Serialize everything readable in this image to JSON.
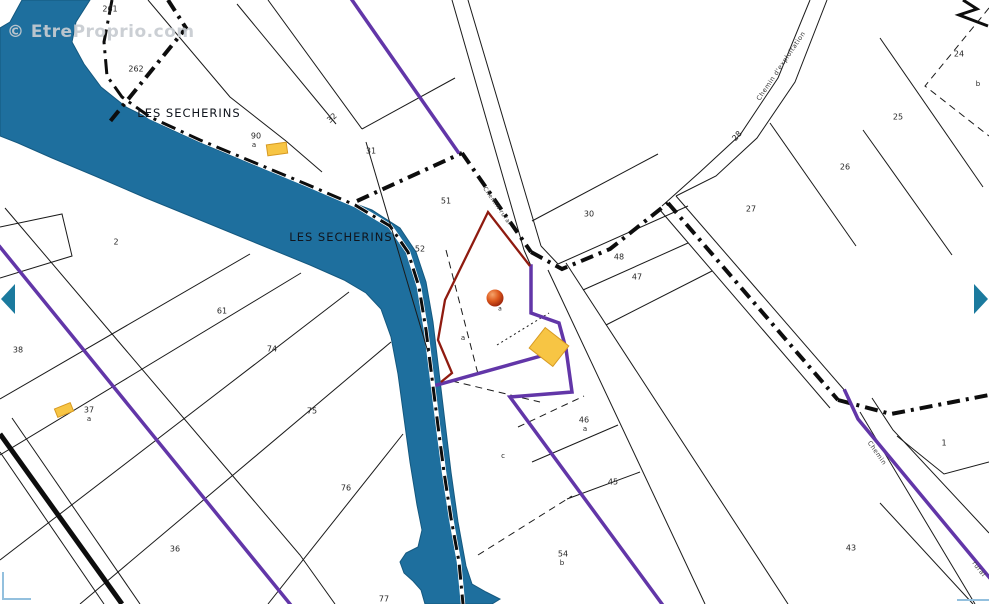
{
  "watermark": {
    "text": "© EtreProprio.com"
  },
  "map": {
    "width": 989,
    "height": 604,
    "colors": {
      "background": "#ffffff",
      "river": "#1E6F9E",
      "river_edge": "#14587F",
      "line": "#1A1A1A",
      "boundary": "#0D0D0D",
      "purple": "#6236A8",
      "red": "#8F1B10",
      "building": "#F7C544",
      "building_edge": "#D79A22",
      "label": "#262626",
      "place": "#10151D",
      "road_label": "#3A3A3A",
      "corner": "#93C0DE",
      "arrow": "#1B7A9E",
      "marker_colors": [
        "#F5A46B",
        "#DE5A1E",
        "#99220A"
      ]
    },
    "river": {
      "path": "M22,0 L90,0 L76,22 L72,42 L84,64 L101,87 L126,107 L168,128 L218,150 L272,172 L326,193 L372,210 L400,228 L416,252 L426,282 L433,322 L439,372 L445,422 L451,472 L458,522 L466,566 L472,584 L486,592 L500,599 L492,604 L425,604 L421,590 L413,581 L404,573 L400,562 L406,553 L418,547 L422,530 L417,505 L410,462 L404,418 L398,374 L391,337 L381,309 L366,293 L344,280 L310,265 L256,243 L200,220 L146,198 L95,176 L52,158 L18,143 L0,136 L0,28 L10,22 Z",
      "centerline": "112,0 104,42 107,76 122,97 150,117 200,140 253,162 306,184 355,205 390,226 408,252 419,287 426,330 432,378 438,426 444,472 451,518 459,562 463,604"
    },
    "thin_lines": [
      {
        "pts": "5,208 300,555 335,604"
      },
      {
        "pts": "250,254 0,399"
      },
      {
        "pts": "301,273 0,455"
      },
      {
        "pts": "349,292 0,560"
      },
      {
        "pts": "391,342 80,604"
      },
      {
        "pts": "0,227 62,214 72,256 0,278"
      },
      {
        "pts": "532,221 658,154"
      },
      {
        "pts": "558,264 688,206"
      },
      {
        "pts": "583,290 688,243"
      },
      {
        "pts": "606,325 712,271"
      },
      {
        "pts": "880,38 983,187"
      },
      {
        "pts": "770,123 856,246"
      },
      {
        "pts": "863,130 952,255"
      },
      {
        "pts": "897,436 944,474 989,462"
      },
      {
        "pts": "880,503 973,604"
      },
      {
        "pts": "366,142 428,352"
      },
      {
        "pts": "362,129 455,78"
      },
      {
        "pts": "148,0 230,97 286,141"
      },
      {
        "pts": "237,4 336,124"
      },
      {
        "pts": "268,0 362,129"
      },
      {
        "pts": "286,141 322,172"
      },
      {
        "pts": "268,604 403,434"
      },
      {
        "pts": "532,462 618,425"
      },
      {
        "pts": "567,499 640,472"
      },
      {
        "pts": "452,0 524,250"
      },
      {
        "pts": "468,0 541,246"
      },
      {
        "pts": "810,0 778,78 740,135 700,172 662,206"
      },
      {
        "pts": "827,0 795,82 757,138 716,176 676,196"
      },
      {
        "pts": "660,210 830,408"
      },
      {
        "pts": "676,196 846,392"
      },
      {
        "pts": "860,412 975,604"
      },
      {
        "pts": "872,398 893,430 989,533"
      },
      {
        "pts": "548,270 705,604"
      },
      {
        "pts": "566,263 788,604"
      },
      {
        "pts": "12,418 140,604"
      },
      {
        "pts": "0,452 104,604"
      },
      {
        "pts": "524,250 531,266"
      },
      {
        "pts": "541,246 558,264"
      }
    ],
    "dashed_lines": [
      {
        "pts": "446,250 478,374",
        "dash": "7 5"
      },
      {
        "pts": "452,381 540,402",
        "dash": "7 5"
      },
      {
        "pts": "478,555 572,496",
        "dash": "7 5"
      },
      {
        "pts": "518,427 584,396",
        "dash": "7 5"
      },
      {
        "pts": "989,8 925,86 989,136",
        "dash": "7 5"
      },
      {
        "pts": "497,345 549,313",
        "dash": "2 3"
      }
    ],
    "thick_road": {
      "pts": "0,434 122,604",
      "width": 5
    },
    "boundaries": [
      {
        "pts": "168,0 186,28 108,124"
      },
      {
        "pts": "357,201 462,153"
      },
      {
        "pts": "462,153 531,252"
      },
      {
        "pts": "531,252 562,269 610,249 668,203"
      },
      {
        "pts": "668,203 838,400"
      },
      {
        "pts": "838,400 891,414 989,395"
      },
      {
        "pts": "963,0 977,9 959,15 988,26",
        "solid": true
      }
    ],
    "purple_lines": [
      {
        "pts": "352,0 458,152"
      },
      {
        "pts": "0,247 290,604"
      },
      {
        "pts": "531,266 531,313 559,323 566,349 572,392 510,397 662,604"
      },
      {
        "pts": "566,349 437,385"
      },
      {
        "pts": "845,391 858,419 989,577"
      }
    ],
    "selected_parcel": {
      "pts": "530,266 488,212 445,300 438,340 452,373 441,382"
    },
    "buildings": [
      {
        "cx": 277,
        "cy": 149,
        "w": 20,
        "h": 11,
        "rot": -8
      },
      {
        "cx": 549,
        "cy": 347,
        "w": 30,
        "h": 26,
        "rot": 38
      },
      {
        "cx": 64,
        "cy": 410,
        "w": 17,
        "h": 9,
        "rot": -22
      }
    ],
    "marker": {
      "cx": 495,
      "cy": 298,
      "r": 8.5
    },
    "arrows": [
      {
        "pts": "1,299 15,284 15,314",
        "name": "map-arrow-left"
      },
      {
        "pts": "988,299 974,284 974,314",
        "name": "map-arrow-right"
      }
    ],
    "corner_marks": [
      {
        "pts": "3,572 3,599 31,599"
      },
      {
        "pts": "957,600 989,600"
      }
    ],
    "parcel_labels": [
      {
        "t": "261",
        "x": 110,
        "y": 9
      },
      {
        "t": "262",
        "x": 136,
        "y": 69
      },
      {
        "t": "90",
        "x": 256,
        "y": 136
      },
      {
        "t": "a",
        "x": 254,
        "y": 145,
        "s": 7
      },
      {
        "t": "31",
        "x": 371,
        "y": 151
      },
      {
        "t": "51",
        "x": 446,
        "y": 201
      },
      {
        "t": "52",
        "x": 420,
        "y": 249
      },
      {
        "t": "2",
        "x": 116,
        "y": 242
      },
      {
        "t": "61",
        "x": 222,
        "y": 311
      },
      {
        "t": "38",
        "x": 18,
        "y": 350
      },
      {
        "t": "74",
        "x": 272,
        "y": 349
      },
      {
        "t": "37",
        "x": 89,
        "y": 410
      },
      {
        "t": "a",
        "x": 89,
        "y": 419,
        "s": 7
      },
      {
        "t": "75",
        "x": 312,
        "y": 411
      },
      {
        "t": "76",
        "x": 346,
        "y": 488
      },
      {
        "t": "36",
        "x": 175,
        "y": 549
      },
      {
        "t": "77",
        "x": 384,
        "y": 599
      },
      {
        "t": "30",
        "x": 589,
        "y": 214
      },
      {
        "t": "48",
        "x": 619,
        "y": 257
      },
      {
        "t": "47",
        "x": 637,
        "y": 277
      },
      {
        "t": "27",
        "x": 751,
        "y": 209
      },
      {
        "t": "26",
        "x": 845,
        "y": 167
      },
      {
        "t": "24",
        "x": 959,
        "y": 54
      },
      {
        "t": "b",
        "x": 978,
        "y": 84,
        "s": 7
      },
      {
        "t": "25",
        "x": 898,
        "y": 117
      },
      {
        "t": "1",
        "x": 944,
        "y": 443
      },
      {
        "t": "43",
        "x": 851,
        "y": 548
      },
      {
        "t": "c",
        "x": 503,
        "y": 456,
        "s": 7
      },
      {
        "t": "46",
        "x": 584,
        "y": 420
      },
      {
        "t": "a",
        "x": 585,
        "y": 429,
        "s": 7
      },
      {
        "t": "45",
        "x": 613,
        "y": 482
      },
      {
        "t": "54",
        "x": 563,
        "y": 554
      },
      {
        "t": "b",
        "x": 562,
        "y": 563,
        "s": 7
      },
      {
        "t": "a",
        "x": 463,
        "y": 338,
        "s": 7
      },
      {
        "t": "a",
        "x": 500,
        "y": 309,
        "s": 6
      },
      {
        "t": "32",
        "x": 332,
        "y": 118,
        "s": 8,
        "r": -42
      },
      {
        "t": "28",
        "x": 737,
        "y": 136,
        "s": 8,
        "r": -48
      }
    ],
    "place_labels": [
      {
        "t": "LES SECHERINS",
        "x": 189,
        "y": 113
      },
      {
        "t": "LES SECHERINS",
        "x": 341,
        "y": 237
      }
    ],
    "road_labels": [
      {
        "t": "Chemin d'exploitation",
        "x": 781,
        "y": 66,
        "r": -56,
        "s": 6.5
      },
      {
        "t": "Chemin rural",
        "x": 497,
        "y": 206,
        "r": 55,
        "s": 6
      },
      {
        "t": "Chemin",
        "x": 877,
        "y": 453,
        "r": 55,
        "s": 6.5
      },
      {
        "t": "rural",
        "x": 979,
        "y": 569,
        "r": 52,
        "s": 6.5
      }
    ]
  }
}
